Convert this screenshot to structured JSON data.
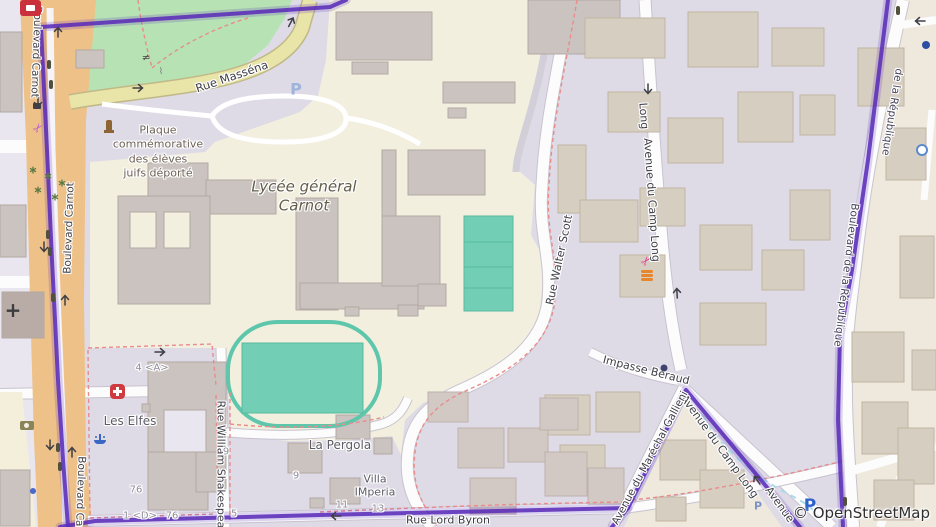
{
  "attribution": {
    "text": "© OpenStreetMap"
  },
  "streets": {
    "boulevard_carnot": "Boulevard Carnot",
    "rue_massena": "Rue Masséna",
    "rue_walter_scott": "Rue Walter Scott",
    "avenue_du_camp_long": "Avenue du Camp Long",
    "avenue_du_camp_long_partial": "Long",
    "impasse_beraud": "Impasse Béraud",
    "boulevard_de_la_republique": "Boulevard de la République",
    "boulevard_de_la_republique_partial": "de la République",
    "rue_william_shakespeare": "Rue William Shakespeare",
    "rue_lord_byron": "Rue Lord Byron",
    "avenue_du_marechal_gallieni": "Avenue du Maréchal Gallieni",
    "avenue_partial": "Avenue"
  },
  "places": {
    "lycee_line1": "Lycée général",
    "lycee_line2": "Carnot",
    "les_elfes": "Les Elfes",
    "la_pergola": "La Pergola",
    "villa_line1": "Villa",
    "villa_line2": "IMperia",
    "plaque_line1": "Plaque",
    "plaque_line2": "commémorative",
    "plaque_line3": "des élèves",
    "plaque_line4": "juifs déporté",
    "partial_name_p": "P"
  },
  "house_numbers": [
    "4 <A>",
    "9",
    "9",
    "76",
    "1 <D>",
    "76",
    "5",
    "11",
    "13"
  ],
  "icons": {
    "parking": "P",
    "scissors": "✂",
    "tree": "∗",
    "gate": "≠",
    "church_cross": "+"
  },
  "colors": {
    "boundary_purple": "#5b2eb8",
    "park_green": "#b7e3b4",
    "pitch_teal": "#72cfb5",
    "road_orange": "#eec189",
    "road_yellow": "#e9e4a8",
    "school_cream": "#f2efdf",
    "urban_lavender": "#dedbe7",
    "district_beige": "#efe9dd",
    "dashed_red": "#e88c8c",
    "stream_cyan": "#a8dcec"
  }
}
